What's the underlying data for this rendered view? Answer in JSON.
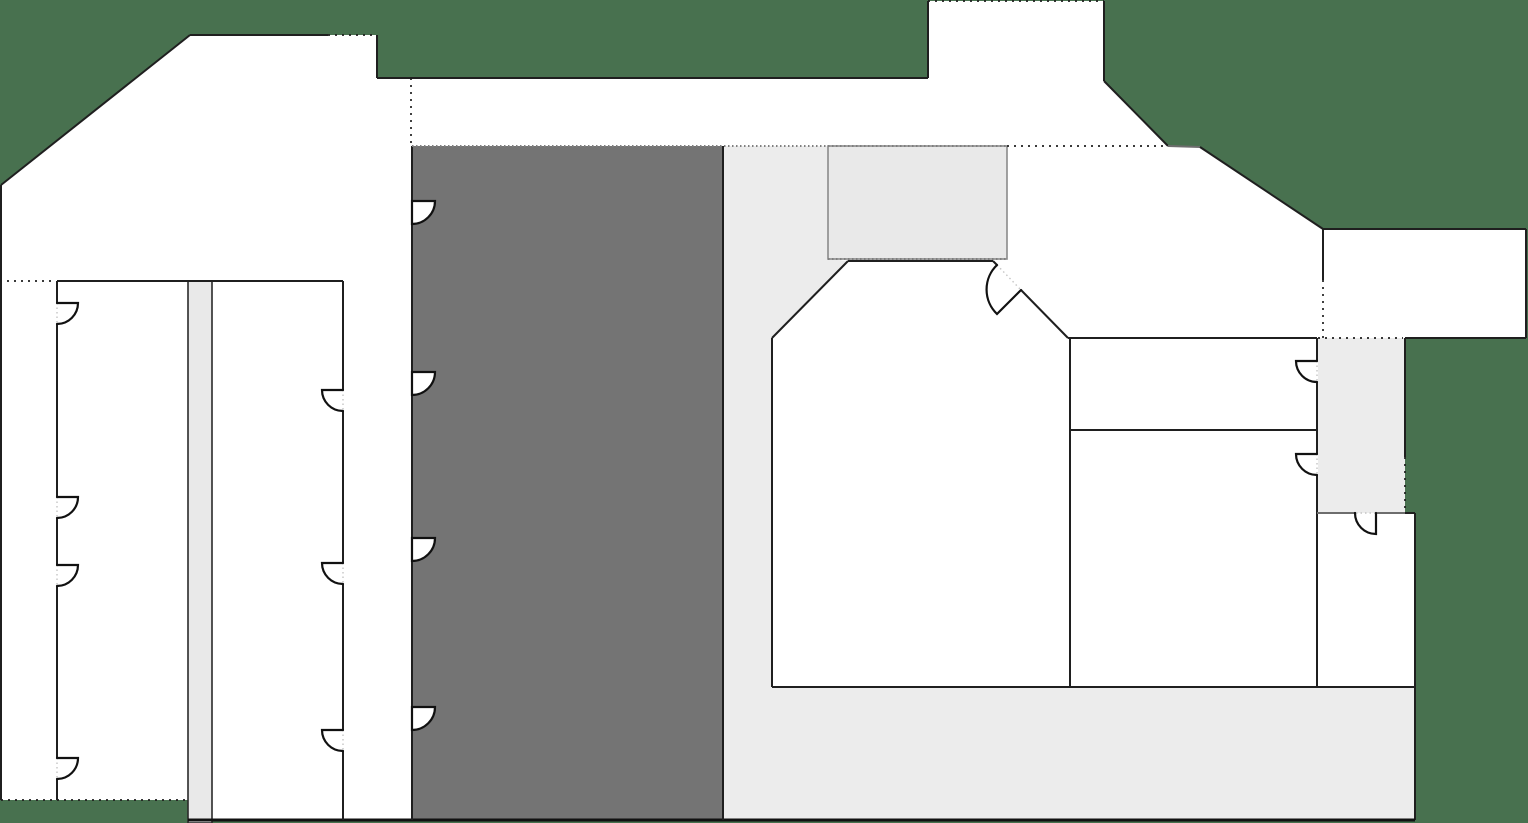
{
  "meta": {
    "description": "Architectural floor plan on dark green site background; no visible text labels",
    "canvas": {
      "width": 1528,
      "height": 823
    }
  },
  "colors": {
    "background": "#48714F",
    "room": "#ffffff",
    "core": "#747474",
    "circulation": "#ececec",
    "service": "#e9e9e9",
    "wall": "#1f1f1f",
    "region_stroke_gray": "#8a8a8a",
    "region_stroke_dark": "#2a2a2a"
  },
  "chart_data": {
    "type": "table",
    "title": "",
    "note": "floor plan geometry (pixel coordinates)",
    "footprint": [
      [
        1,
        185
      ],
      [
        190,
        35
      ],
      [
        377,
        35
      ],
      [
        377,
        78
      ],
      [
        928,
        78
      ],
      [
        928,
        1
      ],
      [
        1104,
        1
      ],
      [
        1104,
        81
      ],
      [
        1168,
        146
      ],
      [
        1200,
        147
      ],
      [
        1323,
        229
      ],
      [
        1526,
        229
      ],
      [
        1526,
        338
      ],
      [
        1405,
        338
      ],
      [
        1405,
        513
      ],
      [
        1415,
        513
      ],
      [
        1415,
        820
      ],
      [
        188,
        820
      ],
      [
        188,
        800
      ],
      [
        1,
        800
      ]
    ]
  },
  "floor_plan": {
    "footprint": [
      [
        1,
        185
      ],
      [
        190,
        35
      ],
      [
        377,
        35
      ],
      [
        377,
        78
      ],
      [
        928,
        78
      ],
      [
        928,
        1
      ],
      [
        1104,
        1
      ],
      [
        1104,
        81
      ],
      [
        1168,
        146
      ],
      [
        1200,
        147
      ],
      [
        1323,
        229
      ],
      [
        1526,
        229
      ],
      [
        1526,
        338
      ],
      [
        1405,
        338
      ],
      [
        1405,
        513
      ],
      [
        1415,
        513
      ],
      [
        1415,
        820
      ],
      [
        188,
        820
      ],
      [
        188,
        800
      ],
      [
        1,
        800
      ]
    ],
    "regions": [
      {
        "name": "core-block",
        "type": "rect",
        "x": 412,
        "y": 146,
        "w": 311,
        "h": 674,
        "fill": "core"
      },
      {
        "name": "circulation-area",
        "type": "polygon",
        "fill": "circulation",
        "pts": [
          [
            723,
            146
          ],
          [
            828,
            146
          ],
          [
            828,
            259
          ],
          [
            848,
            261
          ],
          [
            772,
            338
          ],
          [
            772,
            687
          ],
          [
            1415,
            687
          ],
          [
            1415,
            820
          ],
          [
            723,
            820
          ]
        ]
      },
      {
        "name": "vestibule-room",
        "type": "rect",
        "x": 828,
        "y": 146,
        "w": 179,
        "h": 113,
        "fill": "service",
        "stroke": "#8a8a8a"
      },
      {
        "name": "east-corridor",
        "type": "rect",
        "x": 1318,
        "y": 338,
        "w": 87,
        "h": 175,
        "fill": "circulation"
      },
      {
        "name": "service-column",
        "type": "rect",
        "x": 188,
        "y": 281,
        "w": 24,
        "h": 542,
        "fill": "service",
        "stroke": "#2a2a2a"
      }
    ],
    "walls": [
      {
        "x1": 1,
        "y1": 185,
        "x2": 190,
        "y2": 35,
        "s": "wall"
      },
      {
        "x1": 190,
        "y1": 35,
        "x2": 328,
        "y2": 35,
        "s": "wall"
      },
      {
        "x1": 328,
        "y1": 35,
        "x2": 377,
        "y2": 35,
        "s": "dotted"
      },
      {
        "x1": 377,
        "y1": 35,
        "x2": 377,
        "y2": 78,
        "s": "wall"
      },
      {
        "x1": 377,
        "y1": 78,
        "x2": 928,
        "y2": 78,
        "s": "wall"
      },
      {
        "x1": 928,
        "y1": 78,
        "x2": 928,
        "y2": 1,
        "s": "wall"
      },
      {
        "x1": 928,
        "y1": 1,
        "x2": 1104,
        "y2": 1,
        "s": "dotted"
      },
      {
        "x1": 1104,
        "y1": 1,
        "x2": 1104,
        "y2": 81,
        "s": "wall"
      },
      {
        "x1": 1104,
        "y1": 81,
        "x2": 1168,
        "y2": 146,
        "s": "wall"
      },
      {
        "x1": 1168,
        "y1": 146,
        "x2": 1200,
        "y2": 147,
        "s": "wall-gray"
      },
      {
        "x1": 1200,
        "y1": 147,
        "x2": 1323,
        "y2": 229,
        "s": "wall"
      },
      {
        "x1": 1323,
        "y1": 229,
        "x2": 1526,
        "y2": 229,
        "s": "wall"
      },
      {
        "x1": 1526,
        "y1": 229,
        "x2": 1526,
        "y2": 338,
        "s": "wall"
      },
      {
        "x1": 1526,
        "y1": 338,
        "x2": 1405,
        "y2": 338,
        "s": "wall"
      },
      {
        "x1": 1405,
        "y1": 338,
        "x2": 1405,
        "y2": 457,
        "s": "wall"
      },
      {
        "x1": 1405,
        "y1": 457,
        "x2": 1405,
        "y2": 513,
        "s": "dotted"
      },
      {
        "x1": 1405,
        "y1": 513,
        "x2": 1415,
        "y2": 513,
        "s": "wall"
      },
      {
        "x1": 1415,
        "y1": 513,
        "x2": 1415,
        "y2": 820,
        "s": "wall"
      },
      {
        "x1": 188,
        "y1": 820,
        "x2": 1415,
        "y2": 820,
        "s": "wall-thick"
      },
      {
        "x1": 1,
        "y1": 800,
        "x2": 188,
        "y2": 800,
        "s": "dotted"
      },
      {
        "x1": 1,
        "y1": 185,
        "x2": 1,
        "y2": 800,
        "s": "wall"
      },
      {
        "x1": 57,
        "y1": 281,
        "x2": 343,
        "y2": 281,
        "s": "wall"
      },
      {
        "x1": 57,
        "y1": 281,
        "x2": 57,
        "y2": 303,
        "s": "wall"
      },
      {
        "x1": 57,
        "y1": 324,
        "x2": 57,
        "y2": 497,
        "s": "wall"
      },
      {
        "x1": 57,
        "y1": 518,
        "x2": 57,
        "y2": 565,
        "s": "wall"
      },
      {
        "x1": 57,
        "y1": 586,
        "x2": 57,
        "y2": 758,
        "s": "wall"
      },
      {
        "x1": 57,
        "y1": 779,
        "x2": 57,
        "y2": 800,
        "s": "wall"
      },
      {
        "x1": 343,
        "y1": 281,
        "x2": 343,
        "y2": 390,
        "s": "wall"
      },
      {
        "x1": 343,
        "y1": 411,
        "x2": 343,
        "y2": 563,
        "s": "wall"
      },
      {
        "x1": 343,
        "y1": 584,
        "x2": 343,
        "y2": 730,
        "s": "wall"
      },
      {
        "x1": 343,
        "y1": 751,
        "x2": 343,
        "y2": 820,
        "s": "wall"
      },
      {
        "x1": 412,
        "y1": 146,
        "x2": 412,
        "y2": 201,
        "s": "wall"
      },
      {
        "x1": 412,
        "y1": 224,
        "x2": 412,
        "y2": 372,
        "s": "wall"
      },
      {
        "x1": 412,
        "y1": 395,
        "x2": 412,
        "y2": 538,
        "s": "wall"
      },
      {
        "x1": 412,
        "y1": 561,
        "x2": 412,
        "y2": 707,
        "s": "wall"
      },
      {
        "x1": 412,
        "y1": 730,
        "x2": 412,
        "y2": 820,
        "s": "wall"
      },
      {
        "x1": 723,
        "y1": 146,
        "x2": 723,
        "y2": 820,
        "s": "wall"
      },
      {
        "x1": 772,
        "y1": 338,
        "x2": 772,
        "y2": 687,
        "s": "wall"
      },
      {
        "x1": 772,
        "y1": 338,
        "x2": 848,
        "y2": 261,
        "s": "wall"
      },
      {
        "x1": 848,
        "y1": 261,
        "x2": 993,
        "y2": 261,
        "s": "wall"
      },
      {
        "x1": 993,
        "y1": 261,
        "x2": 997,
        "y2": 265,
        "s": "wall"
      },
      {
        "x1": 997,
        "y1": 265,
        "x2": 1021,
        "y2": 290,
        "s": "dotted-faint"
      },
      {
        "x1": 1021,
        "y1": 290,
        "x2": 1068,
        "y2": 338,
        "s": "wall"
      },
      {
        "x1": 1070,
        "y1": 338,
        "x2": 1070,
        "y2": 687,
        "s": "wall"
      },
      {
        "x1": 1068,
        "y1": 338,
        "x2": 1317,
        "y2": 338,
        "s": "wall"
      },
      {
        "x1": 1070,
        "y1": 430,
        "x2": 1317,
        "y2": 430,
        "s": "wall"
      },
      {
        "x1": 772,
        "y1": 687,
        "x2": 1415,
        "y2": 687,
        "s": "wall"
      },
      {
        "x1": 1317,
        "y1": 338,
        "x2": 1317,
        "y2": 361,
        "s": "wall"
      },
      {
        "x1": 1317,
        "y1": 382,
        "x2": 1317,
        "y2": 454,
        "s": "wall"
      },
      {
        "x1": 1317,
        "y1": 475,
        "x2": 1317,
        "y2": 687,
        "s": "wall"
      },
      {
        "x1": 1317,
        "y1": 513,
        "x2": 1356,
        "y2": 513,
        "s": "wall-gray"
      },
      {
        "x1": 1377,
        "y1": 513,
        "x2": 1405,
        "y2": 513,
        "s": "wall-gray"
      },
      {
        "x1": 1323,
        "y1": 229,
        "x2": 1323,
        "y2": 280,
        "s": "wall"
      },
      {
        "x1": 0,
        "y1": 281,
        "x2": 53,
        "y2": 281,
        "s": "dotted"
      },
      {
        "x1": 411,
        "y1": 78,
        "x2": 411,
        "y2": 146,
        "s": "dotted"
      },
      {
        "x1": 1007,
        "y1": 146,
        "x2": 1168,
        "y2": 146,
        "s": "dotted"
      },
      {
        "x1": 1323,
        "y1": 280,
        "x2": 1323,
        "y2": 338,
        "s": "dotted"
      },
      {
        "x1": 1318,
        "y1": 338,
        "x2": 1403,
        "y2": 338,
        "s": "dotted"
      },
      {
        "x1": 412,
        "y1": 146,
        "x2": 1007,
        "y2": 146,
        "s": "dotted-gray"
      },
      {
        "x1": 828,
        "y1": 259,
        "x2": 1007,
        "y2": 259,
        "s": "dotted-gray"
      },
      {
        "x1": 412,
        "y1": 201,
        "x2": 412,
        "y2": 224,
        "s": "dotted-faint"
      },
      {
        "x1": 412,
        "y1": 372,
        "x2": 412,
        "y2": 395,
        "s": "dotted-faint"
      },
      {
        "x1": 412,
        "y1": 538,
        "x2": 412,
        "y2": 561,
        "s": "dotted-faint"
      },
      {
        "x1": 412,
        "y1": 707,
        "x2": 412,
        "y2": 730,
        "s": "dotted-faint"
      },
      {
        "x1": 57,
        "y1": 303,
        "x2": 57,
        "y2": 324,
        "s": "dotted-faint"
      },
      {
        "x1": 57,
        "y1": 497,
        "x2": 57,
        "y2": 518,
        "s": "dotted-faint"
      },
      {
        "x1": 57,
        "y1": 565,
        "x2": 57,
        "y2": 586,
        "s": "dotted-faint"
      },
      {
        "x1": 57,
        "y1": 758,
        "x2": 57,
        "y2": 779,
        "s": "dotted-faint"
      },
      {
        "x1": 343,
        "y1": 390,
        "x2": 343,
        "y2": 411,
        "s": "dotted-faint"
      },
      {
        "x1": 343,
        "y1": 563,
        "x2": 343,
        "y2": 584,
        "s": "dotted-faint"
      },
      {
        "x1": 343,
        "y1": 730,
        "x2": 343,
        "y2": 751,
        "s": "dotted-faint"
      },
      {
        "x1": 1317,
        "y1": 361,
        "x2": 1317,
        "y2": 382,
        "s": "dotted-faint"
      },
      {
        "x1": 1317,
        "y1": 454,
        "x2": 1317,
        "y2": 475,
        "s": "dotted-faint"
      },
      {
        "x1": 1356,
        "y1": 513,
        "x2": 1377,
        "y2": 513,
        "s": "dotted-faint"
      }
    ],
    "doors": [
      {
        "name": "core-door-1",
        "hx": 412,
        "hy": 201,
        "lx": 435,
        "ly": 201,
        "r": 23,
        "sw": 1,
        "ax": 412,
        "ay": 224,
        "filled": true
      },
      {
        "name": "core-door-2",
        "hx": 412,
        "hy": 372,
        "lx": 435,
        "ly": 372,
        "r": 23,
        "sw": 1,
        "ax": 412,
        "ay": 395,
        "filled": true
      },
      {
        "name": "core-door-3",
        "hx": 412,
        "hy": 538,
        "lx": 435,
        "ly": 538,
        "r": 23,
        "sw": 1,
        "ax": 412,
        "ay": 561,
        "filled": true
      },
      {
        "name": "core-door-4",
        "hx": 412,
        "hy": 707,
        "lx": 435,
        "ly": 707,
        "r": 23,
        "sw": 1,
        "ax": 412,
        "ay": 730,
        "filled": true
      },
      {
        "name": "west-room-door-1",
        "hx": 57,
        "hy": 303,
        "lx": 78,
        "ly": 303,
        "r": 21,
        "sw": 1,
        "ax": 57,
        "ay": 324,
        "filled": false
      },
      {
        "name": "west-room-door-2",
        "hx": 57,
        "hy": 497,
        "lx": 78,
        "ly": 497,
        "r": 21,
        "sw": 1,
        "ax": 57,
        "ay": 518,
        "filled": false
      },
      {
        "name": "west-room-door-3",
        "hx": 57,
        "hy": 565,
        "lx": 78,
        "ly": 565,
        "r": 21,
        "sw": 1,
        "ax": 57,
        "ay": 586,
        "filled": false
      },
      {
        "name": "west-room-door-4",
        "hx": 57,
        "hy": 758,
        "lx": 78,
        "ly": 758,
        "r": 21,
        "sw": 1,
        "ax": 57,
        "ay": 779,
        "filled": false
      },
      {
        "name": "west-room-east-door-1",
        "hx": 343,
        "hy": 390,
        "lx": 322,
        "ly": 390,
        "r": 21,
        "sw": 0,
        "ax": 343,
        "ay": 411,
        "filled": false
      },
      {
        "name": "west-room-east-door-2",
        "hx": 343,
        "hy": 563,
        "lx": 322,
        "ly": 563,
        "r": 21,
        "sw": 0,
        "ax": 343,
        "ay": 584,
        "filled": false
      },
      {
        "name": "west-room-east-door-3",
        "hx": 343,
        "hy": 730,
        "lx": 322,
        "ly": 730,
        "r": 21,
        "sw": 0,
        "ax": 343,
        "ay": 751,
        "filled": false
      },
      {
        "name": "east-room-door-1",
        "hx": 1317,
        "hy": 361,
        "lx": 1296,
        "ly": 361,
        "r": 21,
        "sw": 0,
        "ax": 1317,
        "ay": 382,
        "filled": false
      },
      {
        "name": "east-room-door-2",
        "hx": 1317,
        "hy": 454,
        "lx": 1296,
        "ly": 454,
        "r": 21,
        "sw": 0,
        "ax": 1317,
        "ay": 475,
        "filled": false
      },
      {
        "name": "southeast-room-door",
        "hx": 1376,
        "hy": 513,
        "lx": 1376,
        "ly": 534,
        "r": 21,
        "sw": 1,
        "ax": 1355,
        "ay": 513,
        "filled": false
      },
      {
        "name": "center-room-door",
        "hx": 1021,
        "hy": 290,
        "lx": 997,
        "ly": 314,
        "r": 34,
        "sw": 1,
        "ax": 997,
        "ay": 265,
        "filled": false
      }
    ]
  }
}
